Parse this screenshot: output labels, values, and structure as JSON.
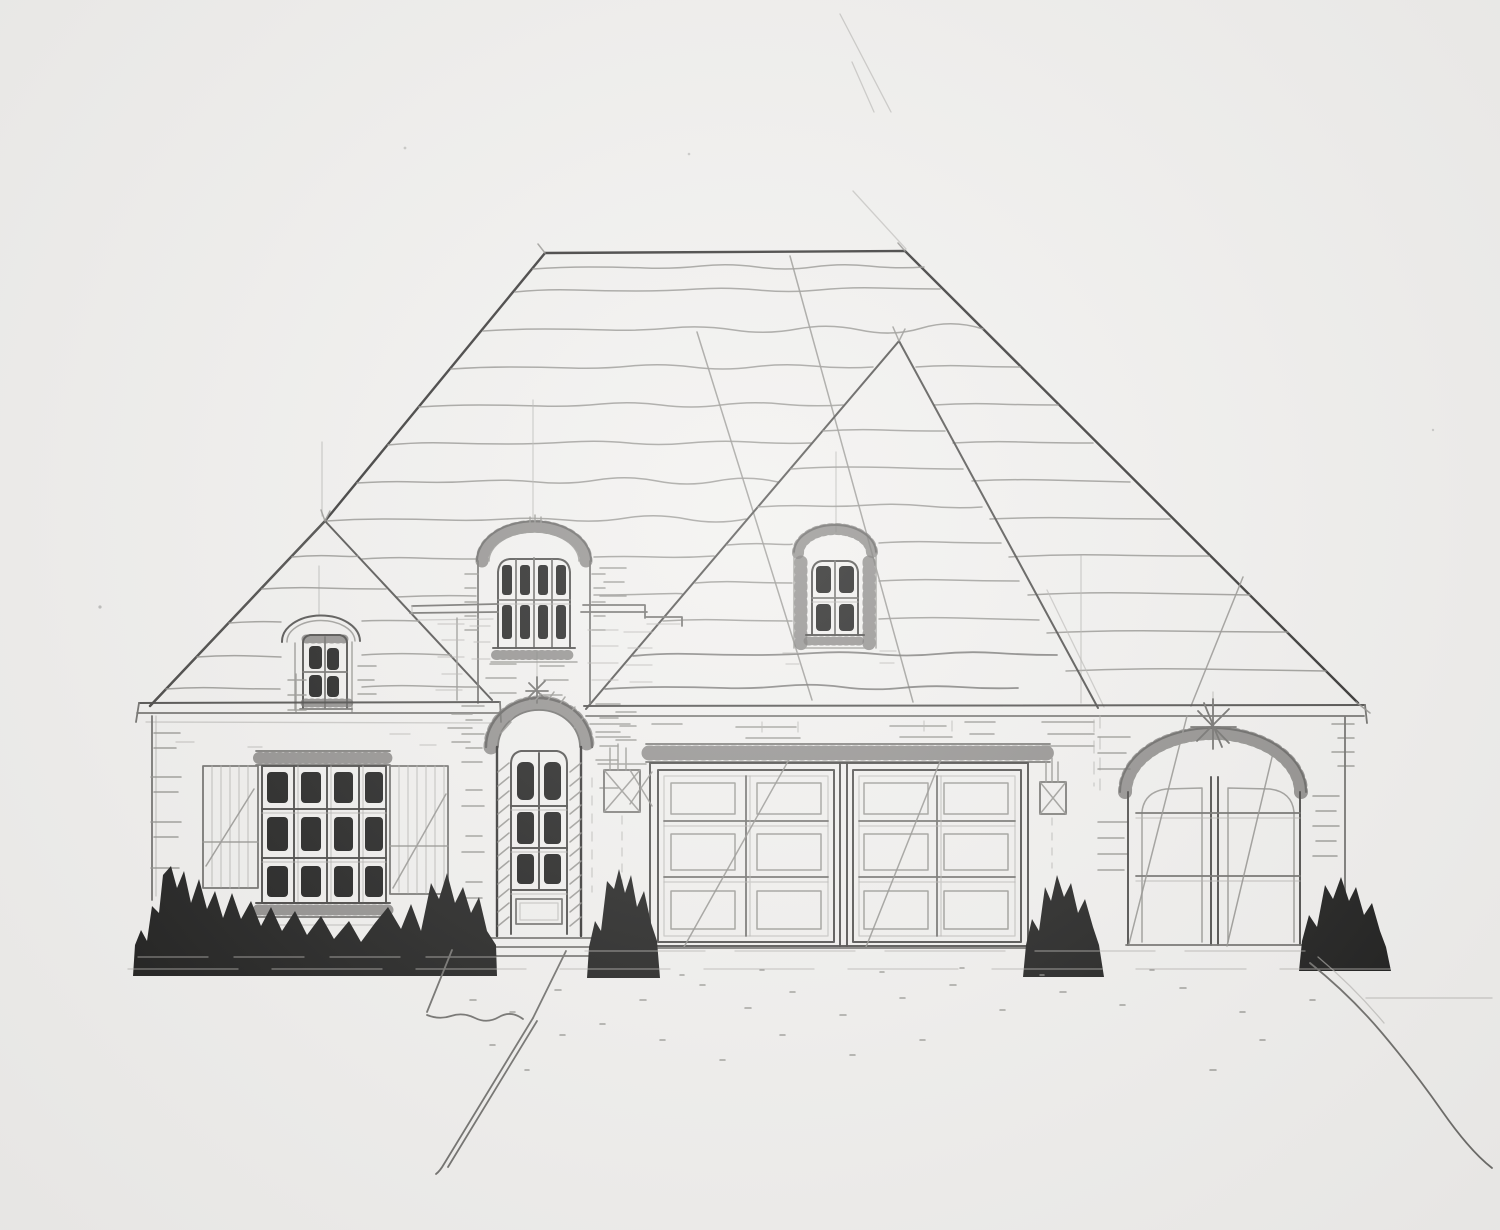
{
  "artwork": {
    "alt": "Pencil and ink architectural sketch: front elevation of a French country style brick house with large hip roof, three arched dormers, shuttered twelve-pane window, arched entry door, two-car garage, arched single garage, solid black ink shrubs, front walkway and driveway",
    "medium": "graphite pencil with black marker shrubs on white paper",
    "colors": {
      "paper": "#f1f0ee",
      "ink": "#171716",
      "pencil_faint": "#b0afac",
      "pencil_light": "#8e8d8a",
      "pencil_mid": "#6c6b68",
      "pencil_dark": "#403f3d",
      "pencil_black": "#2c2b2a"
    },
    "elements": {
      "roof": {
        "type": "hip",
        "shingle_lines": "hand-drawn wavy courses",
        "construction_lines": "long diagonal pencil guides"
      },
      "dormers": [
        {
          "position": "left-wing",
          "shape": "eyebrow arch",
          "panes": "2x2"
        },
        {
          "position": "center-entry",
          "shape": "eyebrow arch",
          "panes": "2x4"
        },
        {
          "position": "right-hip",
          "shape": "eyebrow arch",
          "panes": "2x2"
        }
      ],
      "left_window": {
        "panes": "3x4",
        "shutters": "board-and-batten both sides",
        "lintel": "brick soldier course"
      },
      "entry_door": {
        "style": "arched with brick voussoir surround",
        "panes": "3x2",
        "bottom": "solid panel",
        "steps": 3
      },
      "double_garage": {
        "doors": 2,
        "panels_per_door": "2x3",
        "lintel": "brick soldier course"
      },
      "single_garage": {
        "style": "arched double-leaf carriage door",
        "arch": "brick voussoir with sketched finial"
      },
      "lanterns": 2,
      "shrub_clusters": 4,
      "hardscape": [
        "front walkway lower left",
        "driveway edge lower right"
      ]
    }
  }
}
